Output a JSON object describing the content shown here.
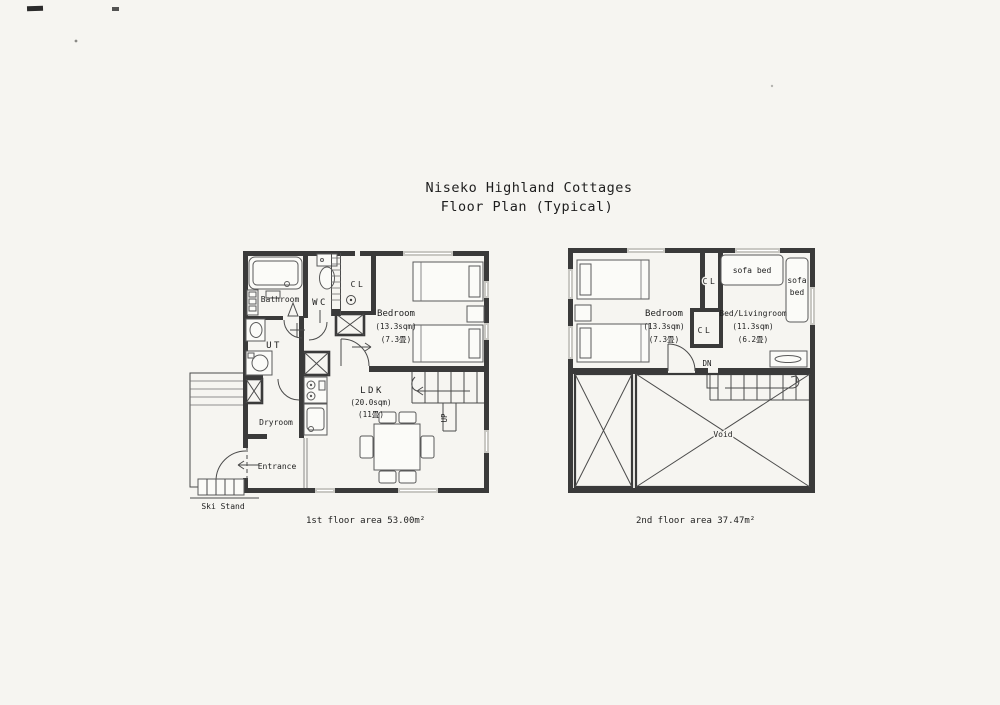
{
  "title": {
    "line1": "Niseko Highland Cottages",
    "line2": "Floor Plan (Typical)"
  },
  "floor1": {
    "caption": "1st floor area 53.00m²",
    "labels": {
      "bathroom": "Bathroom",
      "wc": "WC",
      "cl": "CL",
      "ut": "UT",
      "bedroom_name": "Bedroom",
      "bedroom_area": "(13.3sqm)",
      "bedroom_tatami": "(7.3畳)",
      "ldk_name": "LDK",
      "ldk_area": "(20.0sqm)",
      "ldk_tatami": "(11畳)",
      "dryroom": "Dryroom",
      "entrance": "Entrance",
      "ski_stand": "Ski Stand",
      "up": "UP"
    }
  },
  "floor2": {
    "caption": "2nd floor area 37.47m²",
    "labels": {
      "bedroom_name": "Bedroom",
      "bedroom_area": "(13.3sqm)",
      "bedroom_tatami": "(7.3畳)",
      "cl_upper": "CL",
      "cl_lower": "CL",
      "livingroom_name": "Bed/Livingroom",
      "livingroom_area": "(11.3sqm)",
      "livingroom_tatami": "(6.2畳)",
      "sofa_bed_top": "sofa bed",
      "sofa_bed_side_line1": "sofa",
      "sofa_bed_side_line2": "bed",
      "dn": "DN",
      "void": "Void"
    }
  },
  "colors": {
    "paper": "#f6f5f1",
    "wall": "#3a3a3a",
    "window": "#c9c8c3",
    "ink": "#1e1e1e"
  }
}
